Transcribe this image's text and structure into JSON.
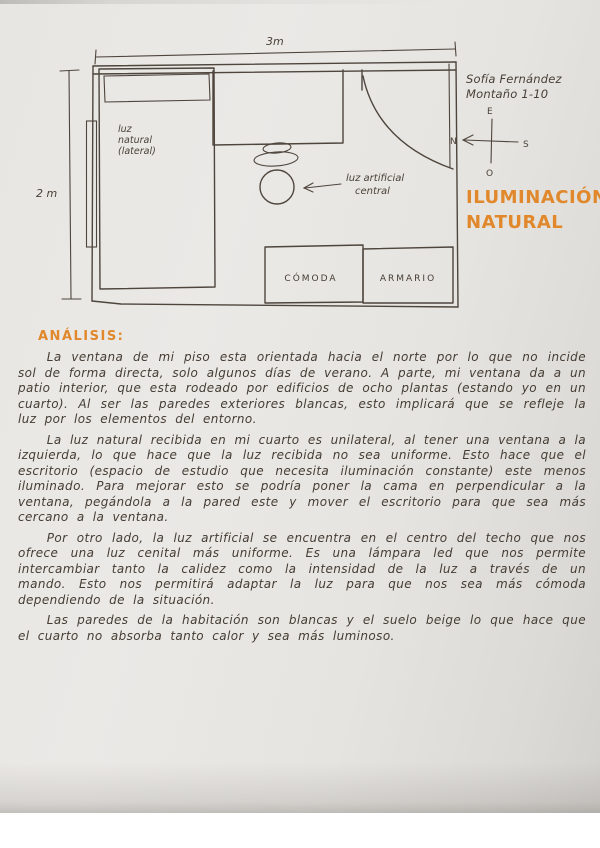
{
  "student": {
    "name_line1": "Sofía Fernández",
    "name_line2": "Montaño 1-10"
  },
  "title": {
    "line1": "ILUMINACIÓN",
    "line2": "NATURAL"
  },
  "floor_plan": {
    "width_label": "3m",
    "height_label": "2 m",
    "window_label_l1": "luz",
    "window_label_l2": "natural",
    "window_label_l3": "(lateral)",
    "lamp_label_l1": "luz artificial",
    "lamp_label_l2": "central",
    "dresser_label": "CÓMODA",
    "wardrobe_label": "ARMARIO",
    "compass": {
      "top": "E",
      "left": "N",
      "right": "S",
      "bottom": "O"
    }
  },
  "analysis": {
    "heading": "ANÁLISIS:",
    "paragraph1": "La ventana de mi piso esta orientada hacia el norte por lo que no incide sol de forma directa, solo algunos días de verano. A parte, mi ventana da a un patio interior, que esta rodeado por edificios de ocho plantas (estando yo en un cuarto). Al ser las paredes exteriores blancas, esto implicará que se refleje la luz por los elementos del entorno.",
    "paragraph2": "La luz natural recibida en mi cuarto es unilateral, al tener una ventana a la izquierda, lo que hace que la luz recibida no sea uniforme. Esto hace que el escritorio (espacio de estudio que necesita iluminación constante) este menos iluminado. Para mejorar esto se podría poner la cama en perpendicular a la ventana, pegándola a la pared este y mover el escritorio para que sea más cercano a la ventana.",
    "paragraph3": "Por otro lado, la luz artificial se encuentra en el centro del techo que nos ofrece una luz cenital más uniforme. Es una lámpara led que nos permite intercambiar tanto la calidez como la intensidad de la luz a través de un mando. Esto nos permitirá adaptar la luz para que nos sea más cómoda dependiendo de la situación.",
    "paragraph4": "Las paredes de la habitación son blancas y el suelo beige lo que hace que el cuarto no absorba tanto calor y sea más luminoso."
  },
  "colors": {
    "accent_orange": "#e0882b",
    "ink": "#4a4138",
    "paper": "#e8e6e2"
  }
}
